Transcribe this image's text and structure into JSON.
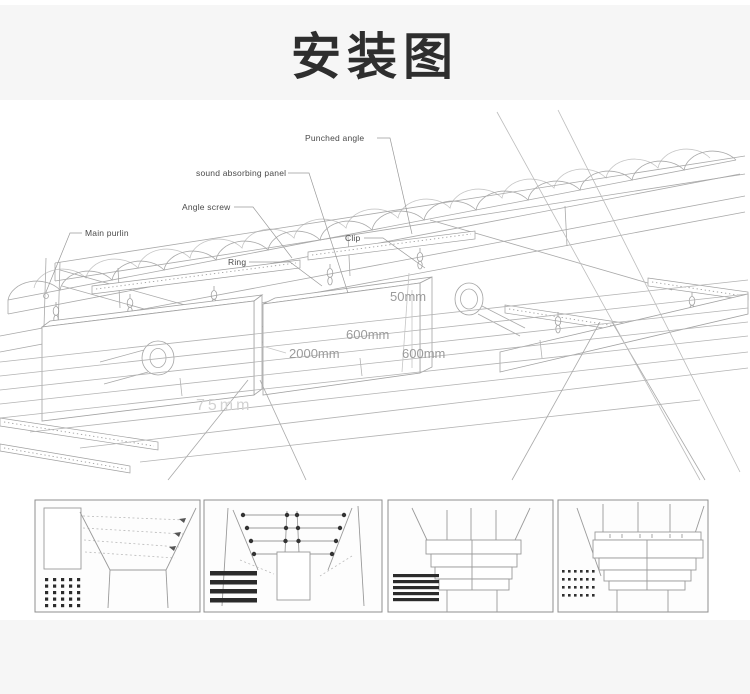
{
  "page": {
    "title": "安装图"
  },
  "diagram": {
    "labels": {
      "punched_angle": "Punched angle",
      "sound_absorbing_panel": "sound absorbing panel",
      "angle_screw": "Angle screw",
      "main_purlin": "Main purlin",
      "clip": "Clip",
      "ring": "Ring"
    },
    "dimensions": {
      "thickness": "50mm",
      "height": "600mm",
      "length": "2000mm",
      "spacing": "600mm",
      "bottom": "75mm"
    },
    "colors": {
      "line": "#a9a9a9",
      "label_text": "#4a4a4a",
      "dimension_text": "#9b9b9b"
    }
  },
  "thumbnails": {
    "count": 4
  }
}
